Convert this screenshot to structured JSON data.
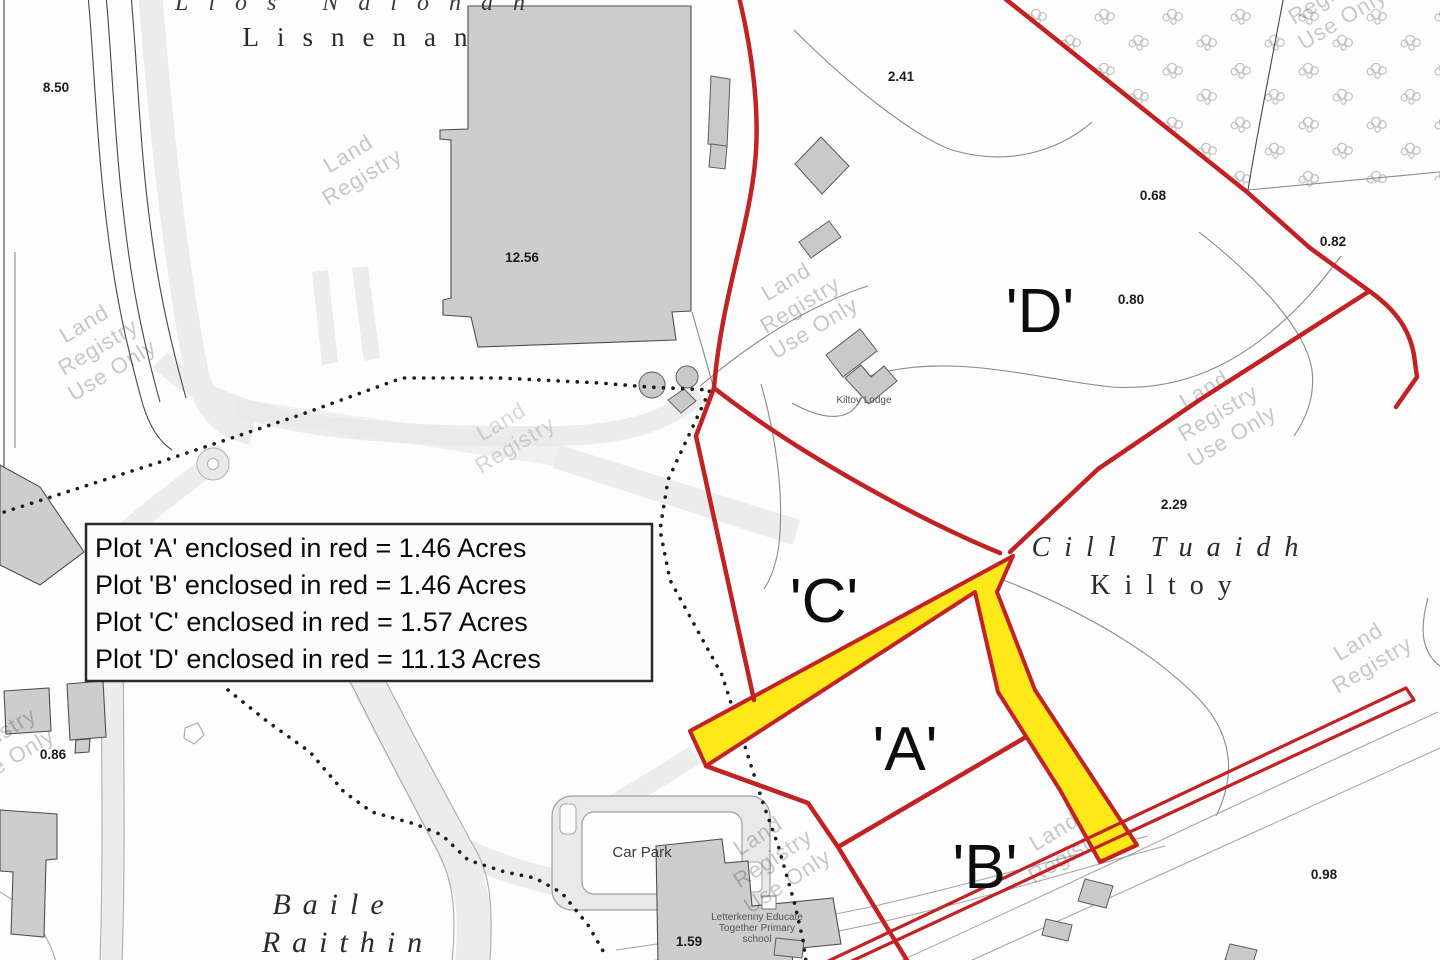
{
  "legend": {
    "lines": [
      "Plot 'A' enclosed in red = 1.46 Acres",
      "Plot 'B' enclosed in red = 1.46 Acres",
      "Plot 'C' enclosed in red = 1.57 Acres",
      "Plot 'D' enclosed in red = 11.13 Acres"
    ]
  },
  "plots": {
    "a": "'A'",
    "b": "'B'",
    "c": "'C'",
    "d": "'D'"
  },
  "townlands": {
    "lisnenan_irish": "Lios Naíonán",
    "lisnenan": "Lisnenan",
    "cill_tuaidh": "Cill Tuaidh",
    "kiltoy": "Kiltoy",
    "baile": "Baile",
    "raithin": "Raithin"
  },
  "areas": {
    "a850": "8.50",
    "a1256": "12.56",
    "a241": "2.41",
    "a068": "0.68",
    "a082": "0.82",
    "a080": "0.80",
    "a229": "2.29",
    "a086": "0.86",
    "a098": "0.98",
    "a159": "1.59"
  },
  "places": {
    "kiltoy_lodge": "Kiltoy Lodge",
    "car_park": "Car Park",
    "school_line1": "Letterkenny Educate",
    "school_line2": "Together Primary",
    "school_line3": "school"
  },
  "watermark": {
    "l1": "Land",
    "l2": "Registry",
    "l3": "Use Only"
  },
  "colors": {
    "boundary_red": "#c32222",
    "highlight_yellow": "#ffe81a",
    "building_gray": "#cdcdcd",
    "watermark_gray": "rgba(40,40,40,0.25)"
  }
}
